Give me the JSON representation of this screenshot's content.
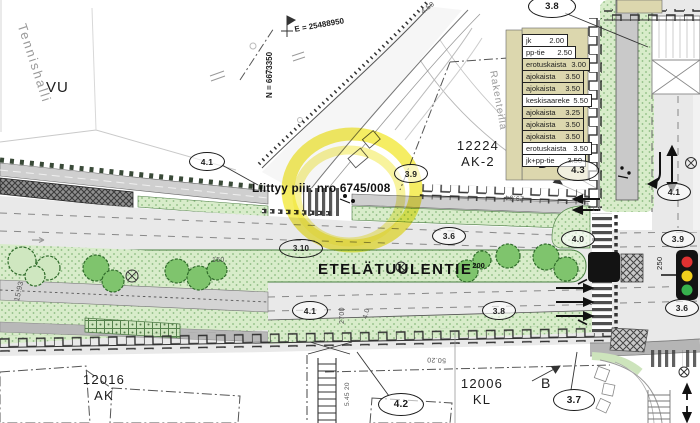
{
  "labels": {
    "tennishalli": "Tennishalli",
    "vu": "VU",
    "rakenteilla": "Rakenteilla",
    "block_12224_code": "12224",
    "block_12224_type": "AK-2",
    "block_12016_code": "12016",
    "block_12016_type": "AK",
    "block_12006_code": "12006",
    "block_12006_type": "KL",
    "street_name": "ETELÄTUULENTIE",
    "street_name_sup": "200",
    "connection_note": "Liittyy piir. nro 6745/008",
    "coord_east": "E = 25488950",
    "coord_north": "N = 6673350",
    "section_marker": "B"
  },
  "cross_section_table": {
    "rows": [
      {
        "label": "jk",
        "value": "2.00"
      },
      {
        "label": "pp-tie",
        "value": "2.50"
      },
      {
        "label": "erotuskaista",
        "value": "3.00"
      },
      {
        "label": "ajokaista",
        "value": "3.50"
      },
      {
        "label": "ajokaista",
        "value": "3.50"
      },
      {
        "label": "keskisaareke",
        "value": "5.50"
      },
      {
        "label": "ajokaista",
        "value": "3.25"
      },
      {
        "label": "ajokaista",
        "value": "3.50"
      },
      {
        "label": "ajokaista",
        "value": "3.50"
      },
      {
        "label": "erotuskaista",
        "value": "3.50"
      },
      {
        "label": "jk+pp-tie",
        "value": "3.50"
      }
    ]
  },
  "ellipse_labels": [
    {
      "text": "4.1"
    },
    {
      "text": "3.9"
    },
    {
      "text": "3.8"
    },
    {
      "text": "4.3"
    },
    {
      "text": "3.6"
    },
    {
      "text": "3.10"
    },
    {
      "text": "4.1"
    },
    {
      "text": "3.8"
    },
    {
      "text": "4.0"
    },
    {
      "text": "4.1"
    },
    {
      "text": "3.9"
    },
    {
      "text": "3.6"
    },
    {
      "text": "4.2"
    },
    {
      "text": "3.7"
    }
  ],
  "micro_labels": [
    {
      "text": "150"
    },
    {
      "text": "2700"
    },
    {
      "text": "4.0"
    },
    {
      "text": "15.93"
    },
    {
      "text": "50.20"
    },
    {
      "text": "29.94"
    },
    {
      "text": "5.45 20"
    },
    {
      "text": "250"
    },
    {
      "text": "1.8"
    },
    {
      "text": "4.50"
    }
  ],
  "colors": {
    "highlight": "#f2e83c",
    "vegetation": "#d8ecca",
    "tree_green": "#7fc46d",
    "roadway": "#e9e9e9",
    "walkway": "#cfcfcf",
    "table_tan": "#dcd7ae",
    "signal_red": "#e03131",
    "signal_amber": "#f2cf1d",
    "signal_green": "#37b24d"
  }
}
